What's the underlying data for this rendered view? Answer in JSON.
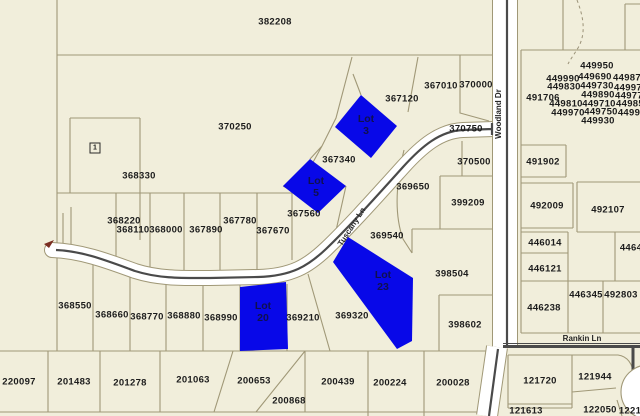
{
  "map": {
    "colors": {
      "background": "#f1eedb",
      "parcel_line": "#a09877",
      "road_fill": "#ffffff",
      "road_centerline": "#4a4a4a",
      "highlight_fill": "#0808e8",
      "highlight_text": "#10104e",
      "label_text": "#1c1c1c",
      "marker_red": "#7a2e22"
    },
    "streets": [
      {
        "name": "Woodland Dr",
        "x": 499,
        "y": 114,
        "angle": -90
      },
      {
        "name": "Tuscany Ln",
        "x": 352,
        "y": 227,
        "angle": -57
      },
      {
        "name": "Rankin Ln",
        "x": 582,
        "y": 339,
        "angle": 0
      }
    ],
    "highlighted_lots": [
      {
        "id": "lot-3",
        "lines": [
          "Lot",
          "3"
        ],
        "x": 366,
        "y": 125
      },
      {
        "id": "lot-5",
        "lines": [
          "Lot",
          "5"
        ],
        "x": 316,
        "y": 187
      },
      {
        "id": "lot-20",
        "lines": [
          "Lot",
          "20"
        ],
        "x": 263,
        "y": 312
      },
      {
        "id": "lot-23",
        "lines": [
          "Lot",
          "23"
        ],
        "x": 383,
        "y": 281
      }
    ],
    "symbols": [
      {
        "id": "boxed-1",
        "text": "1",
        "x": 95,
        "y": 148
      }
    ],
    "parcel_labels": [
      {
        "id": "382208",
        "x": 275,
        "y": 22
      },
      {
        "id": "370250",
        "x": 235,
        "y": 127
      },
      {
        "id": "368330",
        "x": 139,
        "y": 176
      },
      {
        "id": "367120",
        "x": 402,
        "y": 99
      },
      {
        "id": "367010",
        "x": 441,
        "y": 86
      },
      {
        "id": "370000",
        "x": 476,
        "y": 85
      },
      {
        "id": "370750",
        "x": 466,
        "y": 129
      },
      {
        "id": "367340",
        "x": 339,
        "y": 160
      },
      {
        "id": "370500",
        "x": 474,
        "y": 162
      },
      {
        "id": "369650",
        "x": 413,
        "y": 187
      },
      {
        "id": "399209",
        "x": 468,
        "y": 203
      },
      {
        "id": "368220",
        "x": 124,
        "y": 221
      },
      {
        "id": "368110",
        "x": 133,
        "y": 230
      },
      {
        "id": "368000",
        "x": 166,
        "y": 230
      },
      {
        "id": "367890",
        "x": 206,
        "y": 230
      },
      {
        "id": "367780",
        "x": 240,
        "y": 221
      },
      {
        "id": "367670",
        "x": 273,
        "y": 231
      },
      {
        "id": "367560",
        "x": 304,
        "y": 214
      },
      {
        "id": "369540",
        "x": 387,
        "y": 236
      },
      {
        "id": "398504",
        "x": 452,
        "y": 274
      },
      {
        "id": "369210",
        "x": 303,
        "y": 318
      },
      {
        "id": "369320",
        "x": 352,
        "y": 316
      },
      {
        "id": "398602",
        "x": 465,
        "y": 325
      },
      {
        "id": "368550",
        "x": 75,
        "y": 306
      },
      {
        "id": "368660",
        "x": 112,
        "y": 315
      },
      {
        "id": "368770",
        "x": 147,
        "y": 317
      },
      {
        "id": "368880",
        "x": 184,
        "y": 316
      },
      {
        "id": "368990",
        "x": 221,
        "y": 318
      },
      {
        "id": "220097",
        "x": 19,
        "y": 382
      },
      {
        "id": "201483",
        "x": 74,
        "y": 382
      },
      {
        "id": "201278",
        "x": 130,
        "y": 383
      },
      {
        "id": "201063",
        "x": 193,
        "y": 380
      },
      {
        "id": "200653",
        "x": 254,
        "y": 381
      },
      {
        "id": "200868",
        "x": 289,
        "y": 401
      },
      {
        "id": "200439",
        "x": 338,
        "y": 382
      },
      {
        "id": "200224",
        "x": 390,
        "y": 383
      },
      {
        "id": "200028",
        "x": 453,
        "y": 383
      },
      {
        "id": "491706",
        "x": 543,
        "y": 98
      },
      {
        "id": "449990",
        "x": 563,
        "y": 79
      },
      {
        "id": "449830",
        "x": 564,
        "y": 87
      },
      {
        "id": "449810",
        "x": 566,
        "y": 104
      },
      {
        "id": "449970",
        "x": 568,
        "y": 113
      },
      {
        "id": "449950",
        "x": 597,
        "y": 66
      },
      {
        "id": "449690",
        "x": 595,
        "y": 77
      },
      {
        "id": "449730",
        "x": 597,
        "y": 86
      },
      {
        "id": "449890",
        "x": 598,
        "y": 95
      },
      {
        "id": "449710",
        "x": 599,
        "y": 104
      },
      {
        "id": "449750",
        "x": 601,
        "y": 112
      },
      {
        "id": "449930",
        "x": 598,
        "y": 121
      },
      {
        "id": "44987",
        "x": 627,
        "y": 78
      },
      {
        "id": "44997",
        "x": 628,
        "y": 88
      },
      {
        "id": "44977",
        "x": 629,
        "y": 96
      },
      {
        "id": "44985",
        "x": 630,
        "y": 104
      },
      {
        "id": "4499",
        "x": 629,
        "y": 113
      },
      {
        "id": "491902",
        "x": 543,
        "y": 162
      },
      {
        "id": "492009",
        "x": 547,
        "y": 206
      },
      {
        "id": "492107",
        "x": 608,
        "y": 210
      },
      {
        "id": "446014",
        "x": 545,
        "y": 243
      },
      {
        "id": "4464",
        "x": 631,
        "y": 248
      },
      {
        "id": "446121",
        "x": 545,
        "y": 269
      },
      {
        "id": "446238",
        "x": 544,
        "y": 308
      },
      {
        "id": "446345",
        "x": 586,
        "y": 295
      },
      {
        "id": "492803",
        "x": 621,
        "y": 295
      },
      {
        "id": "121720",
        "x": 540,
        "y": 381
      },
      {
        "id": "121944",
        "x": 595,
        "y": 377
      },
      {
        "id": "121613",
        "x": 526,
        "y": 411
      },
      {
        "id": "122050",
        "x": 600,
        "y": 410
      },
      {
        "id": "1221",
        "x": 630,
        "y": 411
      }
    ]
  }
}
